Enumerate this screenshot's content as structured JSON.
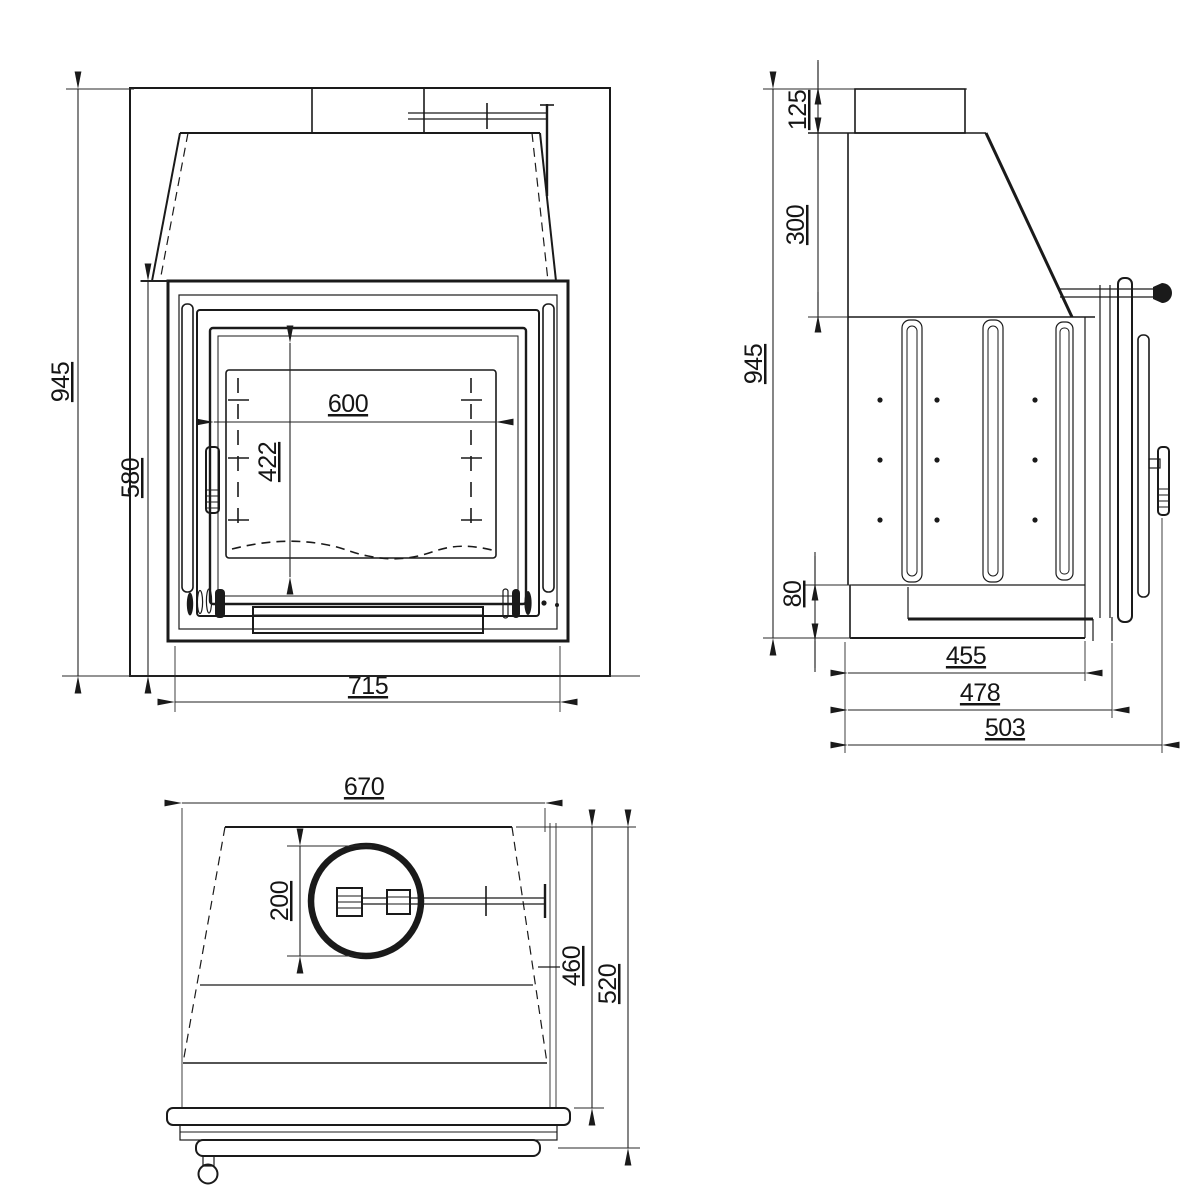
{
  "drawing_title": "Fireplace insert three-view technical drawing",
  "front": {
    "overall_height": "945",
    "firebox_height": "580",
    "glass_width": "600",
    "glass_height": "422",
    "frame_width": "715"
  },
  "side": {
    "collar_height": "125",
    "hood_height": "300",
    "overall_height": "945",
    "base_height": "80",
    "firebox_depth": "455",
    "body_depth": "478",
    "overall_depth": "503"
  },
  "top": {
    "body_width": "670",
    "flue_diameter": "200",
    "body_depth": "460",
    "overall_depth": "520"
  },
  "colors": {
    "line": "#1a1a1a",
    "background": "#ffffff"
  }
}
